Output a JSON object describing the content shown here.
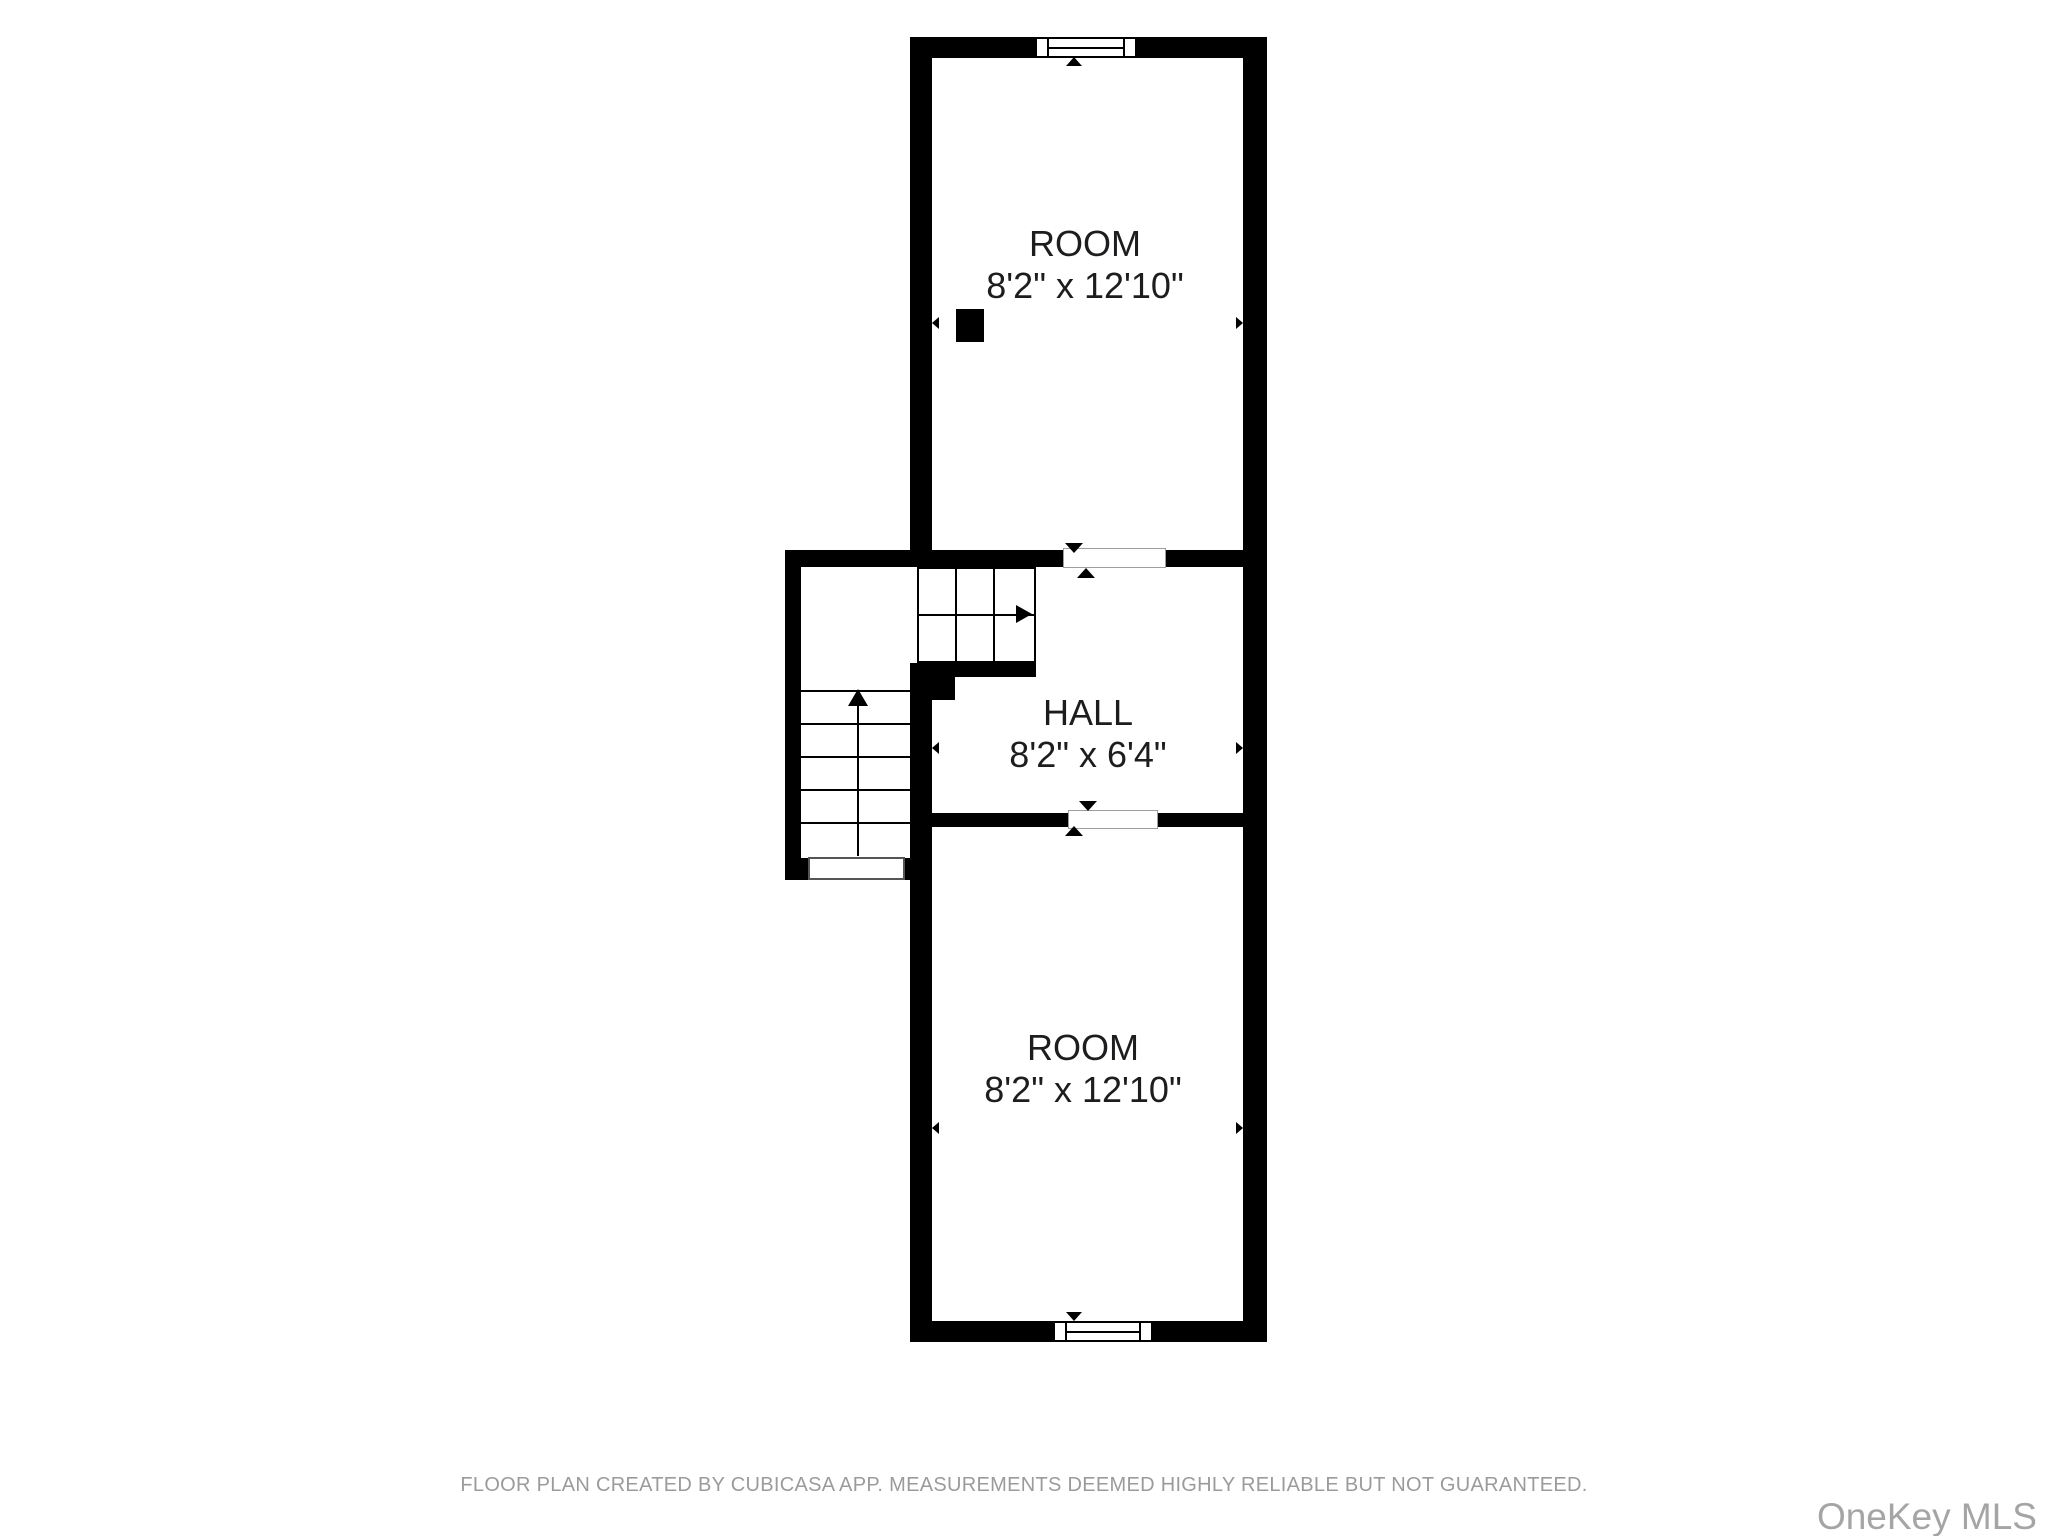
{
  "rooms": [
    {
      "name": "ROOM",
      "dimensions": "8'2\" x 12'10\""
    },
    {
      "name": "HALL",
      "dimensions": "8'2\" x 6'4\""
    },
    {
      "name": "ROOM",
      "dimensions": "8'2\" x 12'10\""
    }
  ],
  "footer": {
    "disclaimer": "FLOOR PLAN CREATED BY CUBICASA APP. MEASUREMENTS DEEMED HIGHLY RELIABLE BUT NOT GUARANTEED."
  },
  "watermark": {
    "text": "OneKey MLS"
  },
  "features": {
    "windows": [
      "top-wall-window",
      "bottom-wall-window"
    ],
    "openings": [
      "top-room-to-hall",
      "hall-to-bottom-room",
      "stairs-exit"
    ],
    "stairs": {
      "shape": "straight run with winder turn",
      "run_arrow": "up",
      "winder_arrow": "right into hall"
    },
    "column": "solid square column in top room"
  },
  "colors": {
    "background": "#ffffff",
    "wall": "#000000",
    "label_text": "#1d1d1f",
    "footer_text": "#9b9b9b",
    "watermark_text": "#a5a5a5"
  }
}
